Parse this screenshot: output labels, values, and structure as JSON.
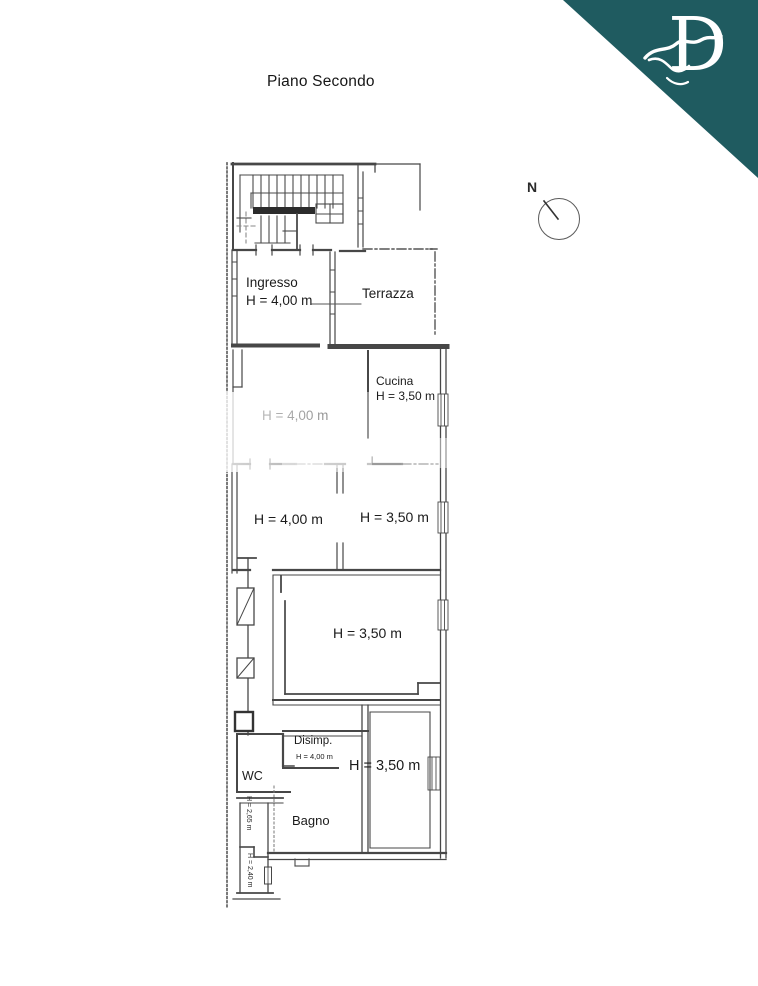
{
  "header": {
    "title": "Piano Secondo"
  },
  "logo": {
    "letter": "D"
  },
  "compass": {
    "north_label": "N"
  },
  "colors": {
    "accent_teal": "#1f5b60",
    "wall_line": "#474747"
  },
  "plan": {
    "floor_name": "Piano Secondo",
    "rooms": [
      {
        "name": "Ingresso",
        "height": "H = 4,00 m"
      },
      {
        "name": "Terrazza",
        "height": ""
      },
      {
        "name": "Cucina",
        "height": "H = 3,50 m"
      },
      {
        "name": "",
        "height": "H = 4,00 m"
      },
      {
        "name": "",
        "height": "H = 4,00 m"
      },
      {
        "name": "",
        "height": "H = 3,50 m"
      },
      {
        "name": "",
        "height": "H = 3,50 m"
      },
      {
        "name": "Disimp.",
        "height": "H = 4,00 m"
      },
      {
        "name": "WC",
        "height": ""
      },
      {
        "name": "Bagno",
        "height": ""
      },
      {
        "name": "",
        "height": "H = 3,50 m"
      },
      {
        "name": "",
        "height": "H = 2,65 m"
      },
      {
        "name": "",
        "height": "H = 2,40 m"
      }
    ]
  }
}
